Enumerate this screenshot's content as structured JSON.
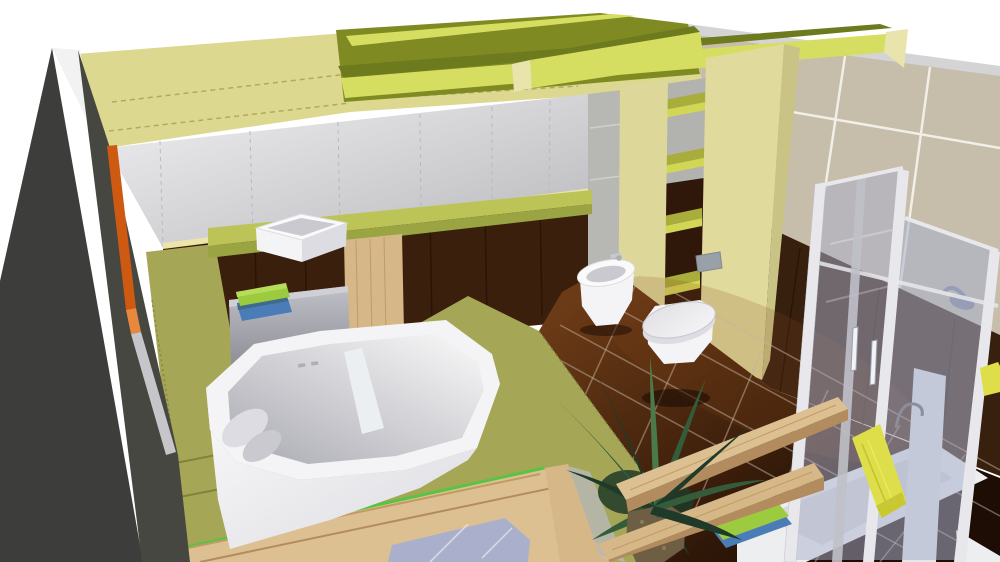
{
  "app": {
    "name": "3D bathroom planner viewport",
    "view": "perspective cutaway render",
    "visible_text": []
  },
  "scene": {
    "room": "bathroom",
    "objects": [
      {
        "id": "left-cutaway-wall",
        "label": "dark cutaway wall nearest camera with orange cut edge"
      },
      {
        "id": "ceiling-beams",
        "label": "yellow-green ceiling beams over bulkhead band"
      },
      {
        "id": "back-wall-panels",
        "label": "white panelled back wall with joint lines"
      },
      {
        "id": "wood-paneling",
        "label": "dark wood wall paneling behind vanity"
      },
      {
        "id": "right-wall-tiles",
        "label": "beige large-format tiled wall"
      },
      {
        "id": "right-wall-wainscot",
        "label": "dark brown lower wall band"
      },
      {
        "id": "floor-tiles",
        "label": "glossy dark brown floor tiles"
      },
      {
        "id": "tub-platform",
        "label": "olive green bathtub platform"
      },
      {
        "id": "bathtub",
        "label": "white bathtub with headrest and divider"
      },
      {
        "id": "vanity-counter",
        "label": "green vanity counter"
      },
      {
        "id": "vessel-basin",
        "label": "white rectangular vessel basin"
      },
      {
        "id": "vanity-drawer",
        "label": "gray drawer unit"
      },
      {
        "id": "wood-cabinet",
        "label": "light wood vanity cabinet"
      },
      {
        "id": "folded-towels",
        "label": "green and blue folded towels"
      },
      {
        "id": "shelf-column",
        "label": "open shelf column with green shelves"
      },
      {
        "id": "toilet-wall",
        "label": "pale yellow half wall for toilet"
      },
      {
        "id": "flush-plate",
        "label": "gray flush plate"
      },
      {
        "id": "bidet",
        "label": "floor bidet with chrome mixer"
      },
      {
        "id": "toilet",
        "label": "wall hung toilet with closed lid"
      },
      {
        "id": "shower-enclosure",
        "label": "corner shower with translucent glass doors"
      },
      {
        "id": "shower-head",
        "label": "shower head behind glass"
      },
      {
        "id": "shower-tray",
        "label": "white shower tray"
      },
      {
        "id": "hanging-towel",
        "label": "yellow towel hanging on shower door"
      },
      {
        "id": "bath-mat",
        "label": "green and blue bath mat"
      },
      {
        "id": "bench-planks",
        "label": "two floating wood bench planks"
      },
      {
        "id": "plant",
        "label": "potted palm plant"
      },
      {
        "id": "framed-panel",
        "label": "wood framed front panel with bright green accent line"
      }
    ]
  },
  "colors": {
    "white_bg": "#ffffff",
    "cut_wall_dark": "#3d3d3b",
    "cut_wall_dark2": "#474741",
    "cut_sliver_white": "#f2f2f2",
    "cut_edge_orange": "#cd5a10",
    "cut_edge_orange2": "#e8883c",
    "cut_edge_gray": "#c6c6ca",
    "band_pale": "#ddd890",
    "band_joint": "#b0aa5e",
    "ceiling_olive": "#7f8b22",
    "beam_bright": "#d6de62",
    "beam_top_olive": "#6e7a1e",
    "beam_end_pale": "#e8e4ac",
    "wall_panel_light": "#f0f0f2",
    "wall_panel_dark": "#b8b8bc",
    "wall_joint": "#b9b9bd",
    "trim_pale": "#ece4a8",
    "paneling_brown": "#3a1f0c",
    "paneling_joint": "#2a1406",
    "tile_beige": "#c6bdaa",
    "tile_grout": "#f2efe6",
    "ceiling_edge_gray": "#d4d4d6",
    "wainscot_brown": "#38200f",
    "wainscot_joint": "#241106",
    "floor_light": "#6b3a16",
    "floor_dark": "#1d0d04",
    "floor_grout": "#c4b49e",
    "floor_sheen": "#8a4a1a",
    "platform_green": "#a6a756",
    "platform_edge": "#797a38",
    "accent_green_line": "#57c445",
    "wood_light": "#ddc092",
    "wood_mid": "#d6b787",
    "wood_grain": "#c29a63",
    "wood_dark_edge": "#b28c5e",
    "counter_green": "#bcc457",
    "counter_edge": "#9aa443",
    "drawer_light": "#cfcfd6",
    "drawer_grad_a": "#c0c0c8",
    "drawer_grad_b": "#8e8e96",
    "towel_green": "#9ccb40",
    "towel_green_hi": "#b7dc5a",
    "towel_blue": "#4a7cb8",
    "towel_teal": "#3f6a8a",
    "porcelain_white": "#fafafa",
    "porcelain_light": "#f4f4f6",
    "porcelain_shade": "#dcdce2",
    "porcelain_mid": "#c9c9cf",
    "porcelain_deep": "#a9a9b2",
    "chrome": "#aab0b8",
    "chrome_light": "#c3c9d1",
    "lid_light": "#f6f6f8",
    "lid_dark": "#e0e0e4",
    "lid_stroke": "#c6c6cc",
    "glass_blue": "#aab0cc",
    "frame_white": "#e8e8ec",
    "frame_shade": "#c0c0c8",
    "handle_chrome": "#f2f3f5",
    "handle_stroke": "#9aa0ae",
    "head_gray": "#767b94",
    "towel_yellow": "#dede4a",
    "towel_yellow_dark": "#c8c832",
    "towel_yellow_line": "#c2c22e",
    "towel_yellow_hi": "#eded6a",
    "hook_gray": "#8a8f9c",
    "tray_white": "#eceef0",
    "tray_inner": "#d8dadd",
    "pot_brown": "#6e5f44",
    "pot_speck1": "#8d7b55",
    "pot_speck2": "#44603f",
    "leaf_dark": "#1f3a28",
    "leaf_mid": "#355c3a",
    "leaf_light": "#4a7a4a",
    "gray_column": "#b7b7b3",
    "gray_column_joint": "#cfcfcc",
    "shelf_bg_gray": "#b2b2ae",
    "shelf_bg_brown": "#2f1809",
    "shelf_top": "#a9ad3c",
    "shelf_edge": "#d2d655",
    "pillar_pale": "#ddd79a",
    "pillar_face": "#e0da9c",
    "pillar_side": "#c9c386",
    "plate_gray": "#9aa0a8",
    "plate_stroke": "#82888f",
    "wall_return_white": "#e4e6e9",
    "shadow": "#150a03",
    "glass_streak": "#ffffff",
    "divider_white": "#eceff1"
  }
}
